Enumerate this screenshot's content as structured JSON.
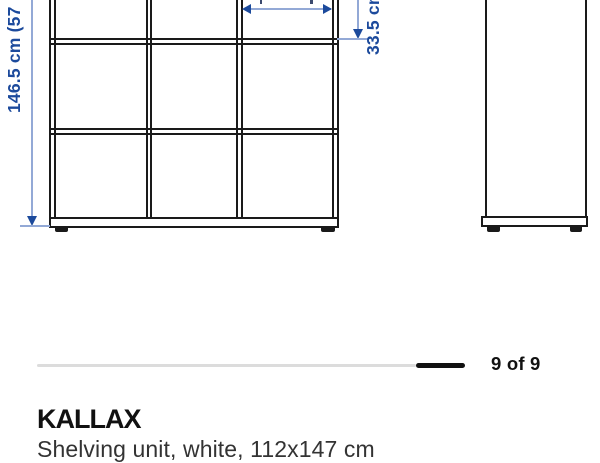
{
  "product": {
    "name": "KALLAX",
    "description": "Shelving unit, white, 112x147 cm"
  },
  "pagination": {
    "label": "9 of 9",
    "current": 9,
    "total": 9
  },
  "diagram": {
    "height_label": "146.5 cm (57 ⅝",
    "depth_label": "33.5 cm",
    "front_view": {
      "columns": 3,
      "visible_rows": 3
    },
    "side_view": {
      "visible": true
    },
    "colors": {
      "drawing_line": "#1a1a1a",
      "dimension_line": "#93a9d6",
      "dimension_text": "#1c4a9c",
      "progress_track": "#dcdcdc",
      "progress_active": "#111111"
    }
  }
}
